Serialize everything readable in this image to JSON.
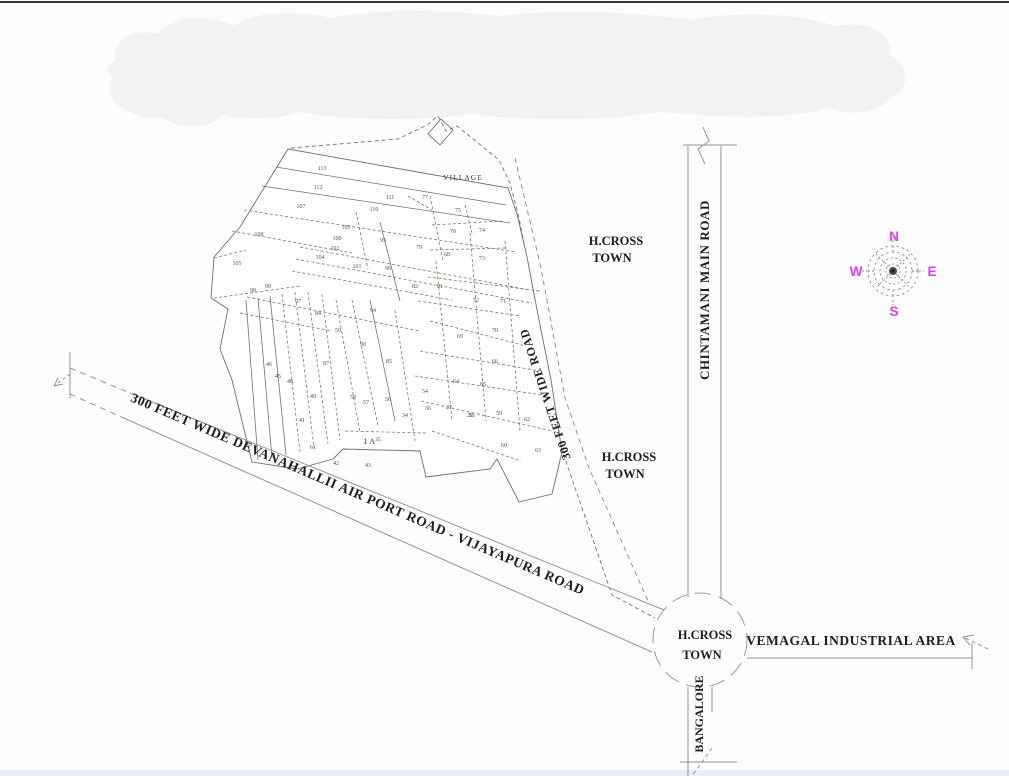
{
  "colors": {
    "compass_accent": "#e83be8",
    "blob_fill": "#f2f2f4",
    "bottom_strip": "#e9edf9",
    "road_line": "#96948f",
    "plot_line": "#7d7668",
    "text_dark": "#1d1d1b"
  },
  "map": {
    "village_label": "VILLAGE",
    "parcel_area_label": "1 A",
    "parcel_area_sup": "35",
    "roads": {
      "airport_road": "300 FEET WIDE DEVANAHALLII AIR PORT ROAD - VIJAYAPURA ROAD",
      "wide_road": "300 FEET WIDE ROAD",
      "chintamani": "CHINTAMANI MAIN ROAD",
      "bangalore": "BANGALORE",
      "vemagal": "VEMAGAL INDUSTRIAL AREA"
    },
    "places": {
      "hcross": [
        "H.CROSS",
        "TOWN"
      ]
    },
    "compass": {
      "n": "N",
      "e": "E",
      "s": "S",
      "w": "W"
    },
    "plots": [
      {
        "n": "113",
        "x": 322,
        "y": 170
      },
      {
        "n": "112",
        "x": 318,
        "y": 189
      },
      {
        "n": "107",
        "x": 301,
        "y": 208
      },
      {
        "n": "111",
        "x": 390,
        "y": 199
      },
      {
        "n": "110",
        "x": 374,
        "y": 211
      },
      {
        "n": "103",
        "x": 346,
        "y": 229
      },
      {
        "n": "100",
        "x": 337,
        "y": 240
      },
      {
        "n": "102",
        "x": 335,
        "y": 250
      },
      {
        "n": "104",
        "x": 320,
        "y": 259
      },
      {
        "n": "101",
        "x": 357,
        "y": 268
      },
      {
        "n": "108",
        "x": 259,
        "y": 236
      },
      {
        "n": "105",
        "x": 237,
        "y": 265
      },
      {
        "n": "99",
        "x": 268,
        "y": 288
      },
      {
        "n": "98",
        "x": 253,
        "y": 292
      },
      {
        "n": "97",
        "x": 298,
        "y": 303
      },
      {
        "n": "84",
        "x": 318,
        "y": 315
      },
      {
        "n": "50",
        "x": 338,
        "y": 332
      },
      {
        "n": "94",
        "x": 373,
        "y": 312
      },
      {
        "n": "90",
        "x": 363,
        "y": 346
      },
      {
        "n": "85",
        "x": 389,
        "y": 363
      },
      {
        "n": "87",
        "x": 326,
        "y": 365
      },
      {
        "n": "46",
        "x": 269,
        "y": 366
      },
      {
        "n": "45",
        "x": 278,
        "y": 378
      },
      {
        "n": "48",
        "x": 290,
        "y": 383
      },
      {
        "n": "49",
        "x": 313,
        "y": 398
      },
      {
        "n": "58",
        "x": 353,
        "y": 399
      },
      {
        "n": "57",
        "x": 366,
        "y": 404
      },
      {
        "n": "56",
        "x": 388,
        "y": 401
      },
      {
        "n": "34",
        "x": 405,
        "y": 417
      },
      {
        "n": "36",
        "x": 428,
        "y": 410
      },
      {
        "n": "27",
        "x": 449,
        "y": 409
      },
      {
        "n": "55",
        "x": 472,
        "y": 417
      },
      {
        "n": "59",
        "x": 499,
        "y": 415
      },
      {
        "n": "62",
        "x": 527,
        "y": 421
      },
      {
        "n": "41",
        "x": 302,
        "y": 422
      },
      {
        "n": "61",
        "x": 313,
        "y": 449
      },
      {
        "n": "42",
        "x": 336,
        "y": 465
      },
      {
        "n": "43",
        "x": 368,
        "y": 467
      },
      {
        "n": "60",
        "x": 504,
        "y": 447
      },
      {
        "n": "63",
        "x": 538,
        "y": 452
      },
      {
        "n": "79",
        "x": 419,
        "y": 249
      },
      {
        "n": "75",
        "x": 458,
        "y": 212
      },
      {
        "n": "78",
        "x": 453,
        "y": 233
      },
      {
        "n": "74",
        "x": 482,
        "y": 232
      },
      {
        "n": "68",
        "x": 447,
        "y": 256
      },
      {
        "n": "73",
        "x": 482,
        "y": 260
      },
      {
        "n": "96",
        "x": 388,
        "y": 270
      },
      {
        "n": "82",
        "x": 415,
        "y": 288
      },
      {
        "n": "81",
        "x": 440,
        "y": 288
      },
      {
        "n": "95",
        "x": 383,
        "y": 242
      },
      {
        "n": "72",
        "x": 476,
        "y": 302
      },
      {
        "n": "71",
        "x": 503,
        "y": 303
      },
      {
        "n": "70",
        "x": 495,
        "y": 332
      },
      {
        "n": "69",
        "x": 460,
        "y": 338
      },
      {
        "n": "66",
        "x": 495,
        "y": 363
      },
      {
        "n": "64",
        "x": 456,
        "y": 383
      },
      {
        "n": "65",
        "x": 483,
        "y": 386
      },
      {
        "n": "54",
        "x": 425,
        "y": 393
      },
      {
        "n": "26",
        "x": 470,
        "y": 417
      },
      {
        "n": "77",
        "x": 425,
        "y": 199
      }
    ]
  }
}
